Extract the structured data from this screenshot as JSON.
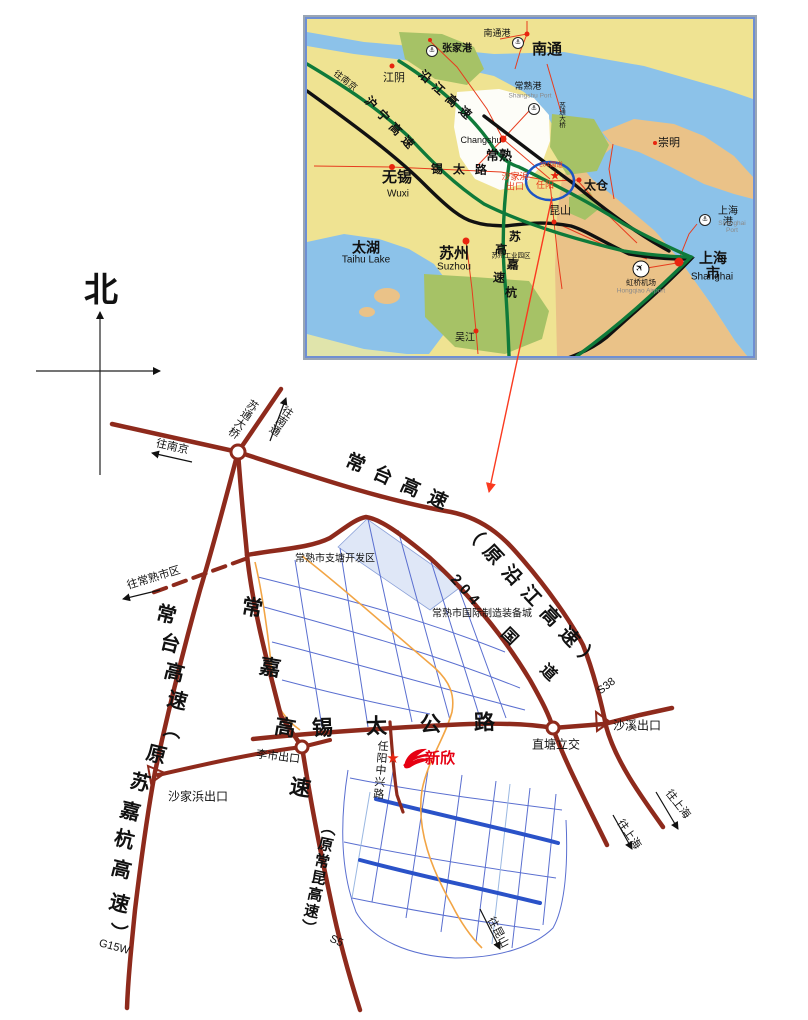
{
  "page": {
    "background": "#ffffff"
  },
  "colors": {
    "road_maroon": "#8e2a1c",
    "inset_land": "#efe392",
    "water": "#8cc2e9",
    "land_tan": "#eac288",
    "green_patch": "#a6c266",
    "pale_band": "#e0e4ab",
    "expressway_green": "#0f7a3a",
    "railway_black": "#111111",
    "local_red": "#e73c1e",
    "grid_blue": "#5a6fd0",
    "major_blue": "#2a52c8",
    "light_blue": "#9ab8e2",
    "orange_road": "#f2a545",
    "highlight_circle": "#1d55c4",
    "shade_fill": "#dfe7f7",
    "logo_red": "#e60012",
    "leader_red": "#fa3a20"
  },
  "compass": {
    "north_label": "北"
  },
  "company": {
    "name": "新欣"
  },
  "inset_labels": [
    {
      "id": "zhangjiagang-port-icon",
      "cls": "porticon",
      "text": "⚓",
      "x": 125,
      "y": 32
    },
    {
      "id": "zhangjiagang-label",
      "text": "张家港",
      "x": 150,
      "y": 31,
      "size": 10,
      "weight": "bold"
    },
    {
      "id": "nantong-port-label",
      "text": "南通港",
      "x": 190,
      "y": 15,
      "size": 9
    },
    {
      "id": "nantong-port-icon",
      "cls": "porticon",
      "text": "⚓",
      "x": 211,
      "y": 24
    },
    {
      "id": "nantong-label",
      "text": "南通",
      "x": 240,
      "y": 31,
      "size": 15,
      "weight": "bold"
    },
    {
      "id": "jiangyin-label",
      "text": "江阴",
      "x": 87,
      "y": 60,
      "size": 11
    },
    {
      "id": "to-nanjing-inset-label",
      "text": "往南京",
      "x": 38,
      "y": 62,
      "size": 9,
      "rotate": 38
    },
    {
      "id": "yanjiang-expwy-label",
      "text": "沿江高速",
      "x": 140,
      "y": 78,
      "size": 12,
      "weight": "bold",
      "rotate": 42,
      "spacing": 6
    },
    {
      "id": "huning-expwy-label",
      "text": "沪宁高速",
      "x": 84,
      "y": 106,
      "size": 12,
      "weight": "bold",
      "rotate": 47,
      "spacing": 6
    },
    {
      "id": "changshu-port-label",
      "text": "常熟港",
      "x": 221,
      "y": 68,
      "size": 9
    },
    {
      "id": "changshu-port-en-label",
      "text": "Shangshu Port",
      "x": 223,
      "y": 77,
      "size": 6.5,
      "color": "#8a8a8a"
    },
    {
      "id": "changshu-port-icon",
      "cls": "porticon",
      "text": "⚓",
      "x": 227,
      "y": 90
    },
    {
      "id": "sutong-bridge-inset-label",
      "text": "苏通大桥",
      "x": 254,
      "y": 96,
      "size": 6.5,
      "vertical": true
    },
    {
      "id": "chongming-label",
      "text": "崇明",
      "x": 362,
      "y": 125,
      "size": 11
    },
    {
      "id": "changshu-en-label",
      "text": "Changshu",
      "x": 174,
      "y": 122,
      "size": 9
    },
    {
      "id": "changshu-label",
      "text": "常熟",
      "x": 192,
      "y": 137,
      "size": 13,
      "weight": "bold"
    },
    {
      "id": "xitai-road-label",
      "text": "锡太路",
      "x": 157,
      "y": 151,
      "size": 12,
      "weight": "bold",
      "spacing": 10,
      "rotate": 1
    },
    {
      "id": "shajiabang-exit-inset-label",
      "text": "沙家浜\n出口",
      "x": 208,
      "y": 163,
      "size": 9,
      "color": "#e73c1e"
    },
    {
      "id": "g204-inset-label",
      "text": "204国道",
      "x": 244,
      "y": 146,
      "size": 6.5,
      "color": "#e73c1e"
    },
    {
      "id": "renyang-label",
      "text": "任阳",
      "x": 238,
      "y": 167,
      "size": 9,
      "color": "#e73c1e"
    },
    {
      "id": "renyang-star-icon",
      "text": "★",
      "x": 248,
      "y": 157,
      "size": 12,
      "color": "#e8250f"
    },
    {
      "id": "wuxi-label",
      "text": "无锡",
      "x": 90,
      "y": 159,
      "size": 15,
      "weight": "bold"
    },
    {
      "id": "wuxi-en-label",
      "text": "Wuxi",
      "x": 91,
      "y": 176,
      "size": 10
    },
    {
      "id": "taicang-label",
      "text": "太仓",
      "x": 289,
      "y": 167,
      "size": 12,
      "weight": "bold"
    },
    {
      "id": "kunshan-label",
      "text": "昆山",
      "x": 253,
      "y": 193,
      "size": 11
    },
    {
      "id": "shanghai-port-icon",
      "cls": "porticon",
      "text": "⚓",
      "x": 398,
      "y": 201
    },
    {
      "id": "shanghai-port-label",
      "text": "上海港",
      "x": 421,
      "y": 199,
      "size": 10
    },
    {
      "id": "shanghai-port-en-label",
      "text": "Shanghai Port",
      "x": 425,
      "y": 208,
      "size": 6.5,
      "color": "#8a8a8a"
    },
    {
      "id": "taihu-label",
      "text": "太湖",
      "x": 59,
      "y": 229,
      "size": 14,
      "weight": "bold"
    },
    {
      "id": "taihu-en-label",
      "text": "Taihu Lake",
      "x": 59,
      "y": 242,
      "size": 10
    },
    {
      "id": "suzhou-label",
      "text": "苏州",
      "x": 147,
      "y": 235,
      "size": 15,
      "weight": "bold"
    },
    {
      "id": "suzhou-en-label",
      "text": "Suzhou",
      "x": 147,
      "y": 249,
      "size": 10
    },
    {
      "id": "suzhou-industrial-park-label",
      "text": "苏州工业园区",
      "x": 204,
      "y": 237,
      "size": 6.5
    },
    {
      "id": "sujiahang-expwy-label",
      "text": "苏嘉杭高速",
      "x": 198,
      "y": 252,
      "size": 12,
      "weight": "bold",
      "vertical": true,
      "spacing": 16,
      "rotate": 4
    },
    {
      "id": "hongqiao-plane-icon",
      "cls": "planeicon",
      "text": "✈",
      "x": 334,
      "y": 250,
      "rotate": -45
    },
    {
      "id": "hongqiao-label",
      "text": "虹桥机场",
      "x": 334,
      "y": 264,
      "size": 7.5
    },
    {
      "id": "hongqiao-en-label",
      "text": "Hongqiao Airport",
      "x": 334,
      "y": 272,
      "size": 6.5,
      "color": "#8a8a8a"
    },
    {
      "id": "shanghai-label",
      "text": "上海市",
      "x": 406,
      "y": 247,
      "size": 14,
      "weight": "bold"
    },
    {
      "id": "shanghai-en-label",
      "text": "Shanghai",
      "x": 405,
      "y": 259,
      "size": 10
    },
    {
      "id": "wujiang-label",
      "text": "吴江",
      "x": 158,
      "y": 320,
      "size": 10
    }
  ],
  "detail_labels": [
    {
      "id": "north-label",
      "text": "北",
      "x": 101,
      "y": 291,
      "size": 34,
      "weight": "bold"
    },
    {
      "id": "sutong-bridge-label",
      "text": "苏通大桥",
      "x": 242,
      "y": 418,
      "size": 11,
      "vertical": true,
      "rotate": 34
    },
    {
      "id": "to-nantong-label",
      "text": "往南通",
      "x": 280,
      "y": 420,
      "size": 11,
      "vertical": true,
      "rotate": 34
    },
    {
      "id": "to-nanjing-label",
      "text": "往南京",
      "x": 172,
      "y": 448,
      "size": 11,
      "rotate": 13
    },
    {
      "id": "changtai-yanjiang-label-1",
      "text": "常台高速",
      "x": 401,
      "y": 485,
      "size": 19,
      "weight": "bold",
      "rotate": 24,
      "spacing": 11
    },
    {
      "id": "changtai-yanjiang-label-2",
      "text": "（原沿江高速）",
      "x": 533,
      "y": 600,
      "size": 19,
      "weight": "bold",
      "rotate": 47,
      "spacing": 9
    },
    {
      "id": "g204-label-num",
      "text": "204",
      "x": 466,
      "y": 592,
      "size": 15,
      "weight": "bold",
      "rotate": 48,
      "spacing": 5
    },
    {
      "id": "g204-label-guo",
      "text": "国",
      "x": 509,
      "y": 637,
      "size": 16,
      "weight": "bold",
      "rotate": 45
    },
    {
      "id": "g204-label-dao",
      "text": "道",
      "x": 548,
      "y": 673,
      "size": 16,
      "weight": "bold",
      "rotate": 45
    },
    {
      "id": "to-changshu-city-label",
      "text": "往常熟市区",
      "x": 154,
      "y": 579,
      "size": 11,
      "rotate": -17
    },
    {
      "id": "zhitang-zone-label",
      "text": "常熟市支塘开发区",
      "x": 335,
      "y": 560,
      "size": 10
    },
    {
      "id": "equipment-city-label",
      "text": "常熟市国际制造装备城",
      "x": 482,
      "y": 615,
      "size": 10
    },
    {
      "id": "changtai-char-1",
      "text": "常",
      "x": 166,
      "y": 616,
      "size": 20,
      "weight": "bold",
      "rotate": 14
    },
    {
      "id": "changtai-char-2",
      "text": "台",
      "x": 170,
      "y": 645,
      "size": 20,
      "weight": "bold",
      "rotate": 14
    },
    {
      "id": "changtai-char-3",
      "text": "高",
      "x": 174,
      "y": 674,
      "size": 20,
      "weight": "bold",
      "rotate": 14
    },
    {
      "id": "changtai-char-4",
      "text": "速",
      "x": 177,
      "y": 702,
      "size": 20,
      "weight": "bold",
      "rotate": 14
    },
    {
      "id": "changtai-char-5",
      "text": "（",
      "x": 171,
      "y": 729,
      "size": 18,
      "weight": "bold",
      "rotate": 100
    },
    {
      "id": "changtai-char-6",
      "text": "原",
      "x": 156,
      "y": 756,
      "size": 20,
      "weight": "bold",
      "rotate": 14
    },
    {
      "id": "changtai-char-7",
      "text": "苏",
      "x": 140,
      "y": 784,
      "size": 20,
      "weight": "bold",
      "rotate": 14
    },
    {
      "id": "changtai-char-8",
      "text": "嘉",
      "x": 130,
      "y": 813,
      "size": 20,
      "weight": "bold",
      "rotate": 14
    },
    {
      "id": "changtai-char-9",
      "text": "杭",
      "x": 124,
      "y": 841,
      "size": 20,
      "weight": "bold",
      "rotate": 14
    },
    {
      "id": "changtai-char-10",
      "text": "高",
      "x": 121,
      "y": 871,
      "size": 20,
      "weight": "bold",
      "rotate": 14
    },
    {
      "id": "changtai-char-11",
      "text": "速",
      "x": 119,
      "y": 905,
      "size": 20,
      "weight": "bold",
      "rotate": 14
    },
    {
      "id": "changtai-char-12",
      "text": "）",
      "x": 117,
      "y": 932,
      "size": 18,
      "weight": "bold",
      "rotate": 100
    },
    {
      "id": "g15w-label",
      "text": "G15W",
      "x": 114,
      "y": 948,
      "size": 11,
      "rotate": 15
    },
    {
      "id": "changjia-char-1",
      "text": "常",
      "x": 252,
      "y": 609,
      "size": 21,
      "weight": "bold",
      "rotate": 10
    },
    {
      "id": "changjia-char-2",
      "text": "嘉",
      "x": 270,
      "y": 669,
      "size": 21,
      "weight": "bold",
      "rotate": 10
    },
    {
      "id": "changjia-char-3",
      "text": "高",
      "x": 285,
      "y": 729,
      "size": 21,
      "weight": "bold",
      "rotate": 10
    },
    {
      "id": "changjia-char-4",
      "text": "速",
      "x": 300,
      "y": 789,
      "size": 21,
      "weight": "bold",
      "rotate": 10
    },
    {
      "id": "changkun-label",
      "text": "（原常昆高速）",
      "x": 317,
      "y": 878,
      "size": 15,
      "weight": "bold",
      "vertical": true,
      "spacing": 2,
      "rotate": 12
    },
    {
      "id": "s5-label",
      "text": "S5",
      "x": 336,
      "y": 942,
      "size": 11,
      "rotate": 25
    },
    {
      "id": "s38-label",
      "text": "S38",
      "x": 607,
      "y": 687,
      "size": 11,
      "rotate": -38
    },
    {
      "id": "xitai-gonglu-label",
      "text": "锡太公路",
      "x": 420,
      "y": 726,
      "size": 21,
      "weight": "bold",
      "spacing": 33,
      "rotate": -2
    },
    {
      "id": "lishi-exit-label",
      "text": "李市出口",
      "x": 278,
      "y": 758,
      "size": 11,
      "rotate": 7
    },
    {
      "id": "zhitang-interchange-label",
      "text": "直塘立交",
      "x": 556,
      "y": 745,
      "size": 12
    },
    {
      "id": "shaxi-exit-label",
      "text": "沙溪出口",
      "x": 637,
      "y": 726,
      "size": 12
    },
    {
      "id": "shajiabang-exit-label",
      "text": "沙家浜出口",
      "x": 198,
      "y": 797,
      "size": 12
    },
    {
      "id": "renyang-zhongxing-road-label",
      "text": "任阳中兴路",
      "x": 379,
      "y": 770,
      "size": 11,
      "vertical": true,
      "spacing": 1,
      "rotate": 5
    },
    {
      "id": "company-star-icon",
      "text": "★",
      "x": 393,
      "y": 759,
      "size": 15,
      "color": "#e8250f"
    },
    {
      "id": "company-name-label",
      "text": "新欣",
      "x": 440,
      "y": 759,
      "size": 15,
      "weight": "bold",
      "color": "#e60012"
    },
    {
      "id": "to-shanghai-label-1",
      "text": "往上海",
      "x": 628,
      "y": 835,
      "size": 11,
      "rotate": 55
    },
    {
      "id": "to-shanghai-label-2",
      "text": "往上海",
      "x": 677,
      "y": 805,
      "size": 11,
      "rotate": 52
    },
    {
      "id": "to-kunshan-label",
      "text": "往昆山",
      "x": 497,
      "y": 933,
      "size": 11,
      "rotate": 62
    }
  ]
}
